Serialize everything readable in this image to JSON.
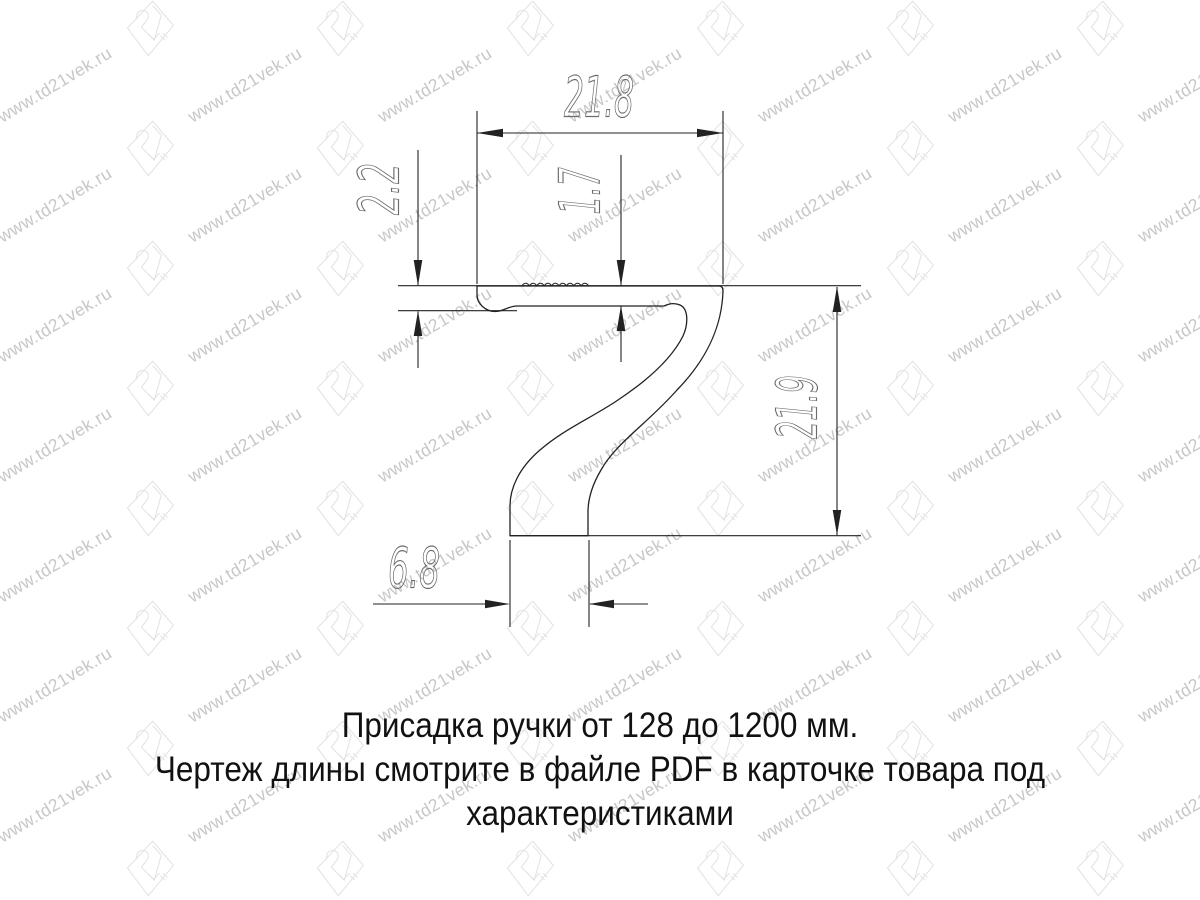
{
  "page": {
    "background": "#ffffff"
  },
  "drawing": {
    "title": "handle-profile-section",
    "line_color": "#222222",
    "dim_text_color": "#6b6b6b",
    "dims": {
      "top_width": "21.8",
      "left_lip_height": "2.2",
      "flange_thickness": "1.7",
      "right_height": "21.9",
      "bottom_foot_width": "6.8"
    }
  },
  "caption": {
    "line1": "Присадка ручки от 128 до 1200 мм.",
    "line2": "Чертеж длины смотрите в файле PDF в карточке товара под",
    "line3": "характеристиками",
    "text_color": "#111111"
  },
  "watermark": {
    "text": "www.td21vek.ru",
    "text_color": "#c7c7c7",
    "logo_color": "#e3e3e3"
  }
}
